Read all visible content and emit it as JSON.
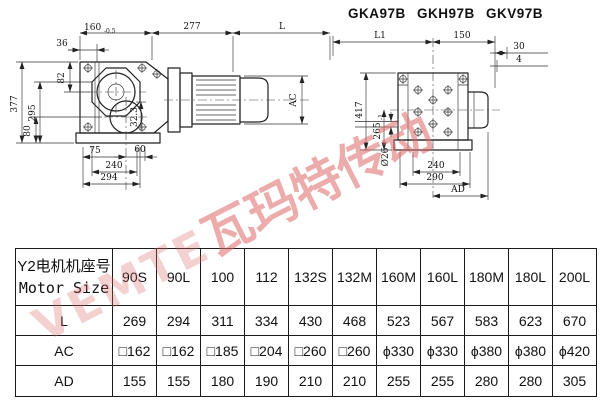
{
  "title": "GKA97B GKH97B GKV97B",
  "watermark": {
    "latin": "VEMTE",
    "cjk": "瓦玛特传动",
    "color": "#dd6a6a"
  },
  "side_view": {
    "d160": "160",
    "d160_tol": "-0.5",
    "d277": "277",
    "dL": "L",
    "d36": "36",
    "d377": "377",
    "d295": "295",
    "d82": "82",
    "d80": "80",
    "dAC": "AC",
    "d75": "75",
    "d60": "60",
    "d240": "240",
    "d294": "294",
    "d32_3": "32.3"
  },
  "front_view": {
    "dL1": "L1",
    "d150": "150",
    "d30": "30",
    "d4": "4",
    "d417": "417",
    "d265": "265",
    "d265_tol": "-1",
    "d26": "Ø26",
    "d240": "240",
    "d290": "290",
    "dAD": "AD"
  },
  "table": {
    "header_cn": "Y2电机机座号",
    "header_en": "Motor Size",
    "columns": [
      "90S",
      "90L",
      "100",
      "112",
      "132S",
      "132M",
      "160M",
      "160L",
      "180M",
      "180L",
      "200L"
    ],
    "rows": [
      {
        "label": "L",
        "values": [
          "269",
          "294",
          "311",
          "334",
          "430",
          "468",
          "523",
          "567",
          "583",
          "623",
          "670"
        ]
      },
      {
        "label": "AC",
        "values": [
          "□162",
          "□162",
          "□185",
          "□204",
          "□260",
          "□260",
          "ϕ330",
          "ϕ330",
          "ϕ380",
          "ϕ380",
          "ϕ420"
        ]
      },
      {
        "label": "AD",
        "values": [
          "155",
          "155",
          "180",
          "190",
          "210",
          "210",
          "255",
          "255",
          "280",
          "280",
          "305"
        ]
      }
    ]
  }
}
